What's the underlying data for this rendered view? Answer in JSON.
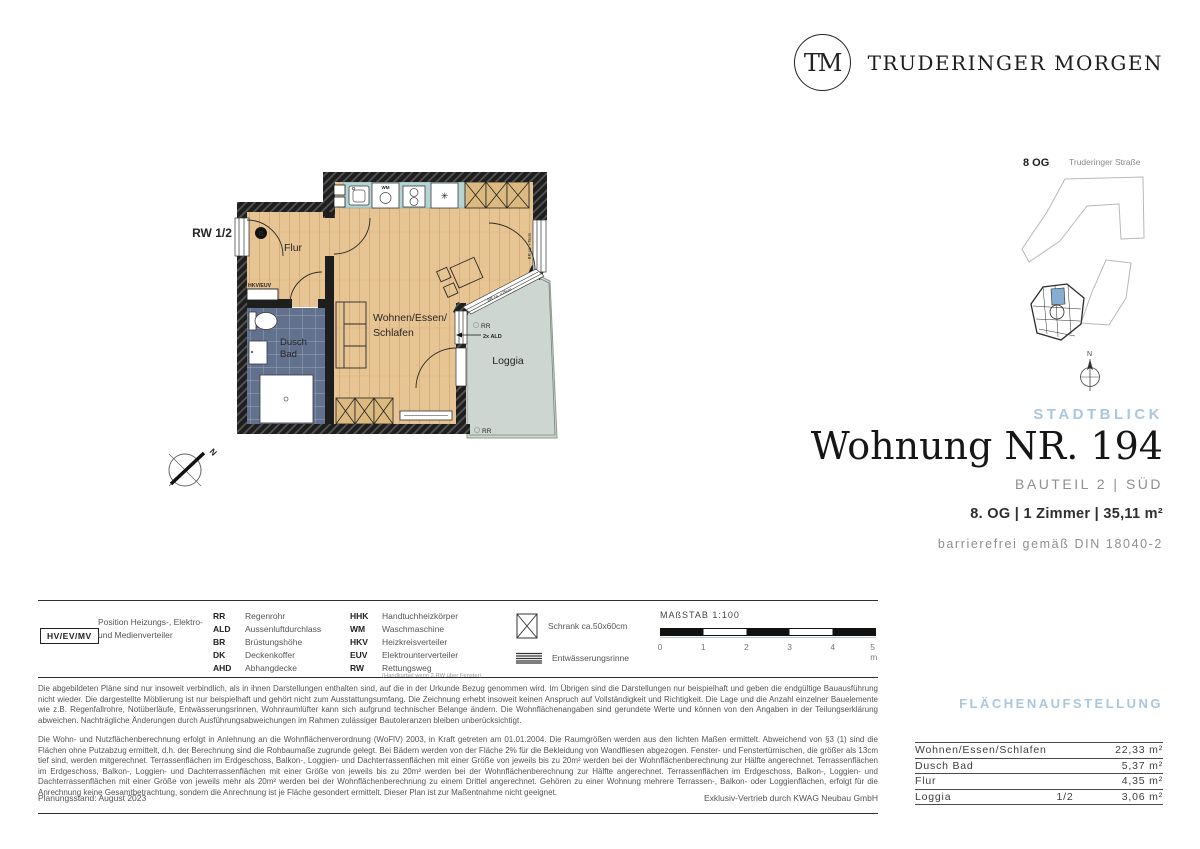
{
  "colors": {
    "accent_blue": "#a9c7e1",
    "wood": "#e7c493",
    "wood_line": "#d6ae77",
    "bath_tile": "#61718e",
    "kitchen_counter": "#b5d4d4",
    "loggia_floor": "#cdd6d0",
    "wall_dark": "#1e1e1e",
    "unit_highlight": "#85aed1"
  },
  "brand": {
    "monogram": "TM",
    "name": "TRUDERINGER MORGEN"
  },
  "site_plan": {
    "floor": "8 OG",
    "street": "Truderinger Straße",
    "north": "N"
  },
  "floor_plan": {
    "escape_route": "RW 1/2",
    "entrance_marker": "B",
    "hall": "Flur",
    "distributor": "HKV/EUV",
    "bath_line1": "Dusch",
    "bath_line2": "Bad",
    "towel_radiator": "HHK",
    "living_line1": "Wohnen/Essen/",
    "living_line2": "Schlafen",
    "loggia": "Loggia",
    "washing_machine": "WM",
    "rain_pipe": "RR",
    "air_inlet": "2x ALD",
    "window_note": "BR ca. +75cm",
    "north": "N"
  },
  "title_block": {
    "project": "STADTBLICK",
    "title": "Wohnung NR. 194",
    "subtitle": "BAUTEIL 2 | SÜD",
    "details": "8. OG | 1 Zimmer | 35,11 m²",
    "accessibility": "barrierefrei gemäß DIN 18040-2"
  },
  "legend": {
    "distributor_box": "HV/EV/MV",
    "distributor_text": "Position Heizungs-, Elektro- und Medienverteiler",
    "col1": [
      {
        "abbr": "RR",
        "term": "Regenrohr"
      },
      {
        "abbr": "ALD",
        "term": "Aussenluftdurchlass"
      },
      {
        "abbr": "BR",
        "term": "Brüstungshöhe"
      },
      {
        "abbr": "DK",
        "term": "Deckenkoffer"
      },
      {
        "abbr": "AHD",
        "term": "Abhangdecke"
      }
    ],
    "col2": [
      {
        "abbr": "HHK",
        "term": "Handtuchheizkörper"
      },
      {
        "abbr": "WM",
        "term": "Waschmaschine"
      },
      {
        "abbr": "HKV",
        "term": "Heizkreisverteiler"
      },
      {
        "abbr": "EUV",
        "term": "Elektrounterverteiler"
      },
      {
        "abbr": "RW",
        "term": "Rettungsweg",
        "note": "(Handkurbel wenn 2.RW über Fenster)"
      }
    ],
    "symbols": [
      {
        "label": "Schrank ca.50x60cm"
      },
      {
        "label": "Entwässerungsrinne"
      }
    ]
  },
  "scale_bar": {
    "label": "MAßSTAB 1:100",
    "ticks": [
      "0",
      "1",
      "2",
      "3",
      "4",
      "5 m"
    ]
  },
  "disclaimer": {
    "p1": "Die abgebildeten Pläne sind nur insoweit verbindlich, als in ihnen Darstellungen enthalten sind, auf die in der Urkunde Bezug genommen wird. Im Übrigen sind die Darstellungen nur beispielhaft und geben die endgültige Bauausführung nicht wieder. Die dargestellte Möblierung ist nur beispielhaft und gehört nicht zum Ausstattungsumfang. Die Zeichnung erhebt insoweit keinen Anspruch auf Vollständigkeit und Richtigkeit. Die Lage und die Anzahl einzelner Bauelemente wie z.B. Regenfallrohre, Notüberläufe, Entwässerungsrinnen, Wohnraumlüfter kann sich aufgrund technischer Belange ändern. Die Wohnflächenangaben sind gerundete Werte und können von den Angaben in der Teilungserklärung abweichen. Nachträgliche Änderungen durch Ausführungsabweichungen im Rahmen zulässiger Bautoleranzen bleiben unberücksichtigt.",
    "p2": "Die Wohn- und Nutzflächenberechnung erfolgt in Anlehnung an die Wohnflächenverordnung (WoFlV) 2003, in Kraft getreten am 01.01.2004. Die Raumgrößen werden aus den lichten Maßen ermittelt. Abweichend von §3 (1) sind die Flächen ohne Putzabzug ermittelt, d.h. der Berechnung sind die Rohbaumaße zugrunde gelegt. Bei Bädern werden von der Fläche 2% für die Bekleidung von Wandfliesen abgezogen. Fenster- und Fenstertürnischen, die größer als 13cm tief sind, werden mitgerechnet. Terrassenflächen im Erdgeschoss, Balkon-, Loggien- und Dachterrassenflächen mit einer Größe von jeweils bis zu 20m² werden bei der Wohnflächenberechnung zur Hälfte angerechnet. Terrassenflächen im Erdgeschoss, Balkon-, Loggien- und Dachterrassenflächen mit einer Größe von jeweils bis zu 20m² werden bei der Wohnflächenberechnung zur Hälfte angerechnet. Terrassenflächen im Erdgeschoss, Balkon-, Loggien- und Dachterrassenflächen mit einer Größe von jeweils mehr als 20m² werden bei der Wohnflächenberechnung zu einem Drittel angerechnet. Gehören zu einer Wohnung mehrere Terrassen-, Balkon- oder Loggienflächen, erfolgt für die Anrechnung keine Gesamtbetrachtung, sondern die Anrechnung ist je Fläche gesondert ermittelt. Dieser Plan ist zur Maßentnahme nicht geeignet."
  },
  "footer": {
    "planning_status": "Planungsstand: August 2023",
    "distribution": "Exklusiv-Vertrieb durch KWAG Neubau GmbH"
  },
  "area_table": {
    "heading": "FLÄCHENAUFSTELLUNG",
    "rows": [
      {
        "label": "Wohnen/Essen/Schlafen",
        "fraction": "",
        "value": "22,33 m²"
      },
      {
        "label": "Dusch Bad",
        "fraction": "",
        "value": "5,37 m²"
      },
      {
        "label": "Flur",
        "fraction": "",
        "value": "4,35 m²"
      },
      {
        "label": "Loggia",
        "fraction": "1/2",
        "value": "3,06 m²"
      }
    ]
  }
}
